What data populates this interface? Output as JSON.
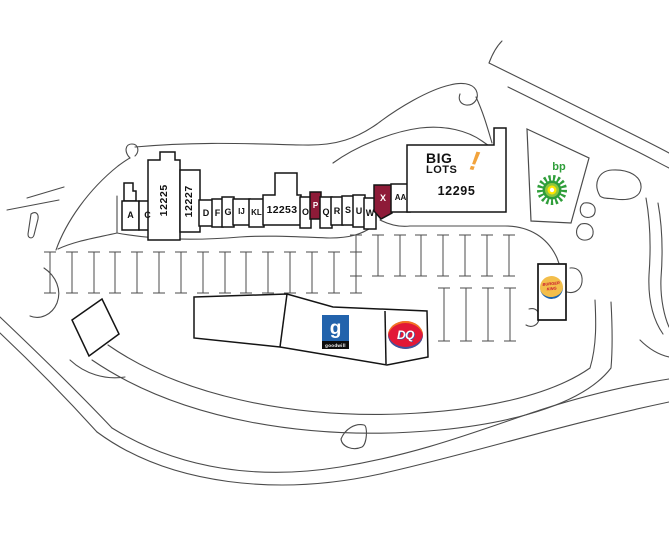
{
  "plaza": {
    "units": [
      {
        "label": "A"
      },
      {
        "label": "C"
      },
      {
        "label": "12225"
      },
      {
        "label": "12227"
      },
      {
        "label": "D"
      },
      {
        "label": "F"
      },
      {
        "label": "G"
      },
      {
        "label": "IJ"
      },
      {
        "label": "KL"
      },
      {
        "label": "12253"
      },
      {
        "label": "O"
      },
      {
        "label": "P",
        "highlighted": true
      },
      {
        "label": "Q"
      },
      {
        "label": "R"
      },
      {
        "label": "S"
      },
      {
        "label": "U"
      },
      {
        "label": "W"
      },
      {
        "label": "X",
        "highlighted": true
      },
      {
        "label": "AA"
      }
    ],
    "anchor": {
      "name_line1": "BIG",
      "name_line2": "LOTS",
      "exclamation": "!",
      "address": "12295"
    }
  },
  "outparcels": {
    "bp": {
      "name": "bp"
    },
    "goodwill": {
      "glyph": "g",
      "name": "goodwill"
    },
    "dairy_queen": {
      "name": "DQ"
    },
    "burger_king": {
      "name_line1": "BURGER",
      "name_line2": "KING"
    }
  },
  "colors": {
    "highlight_red": "#8E1B38",
    "biglots_orange": "#F2A33C",
    "bp_green": "#2F9E3A",
    "bp_light_green": "#8DC63F",
    "bp_yellow": "#FFE600",
    "goodwill_blue": "#2263AC",
    "dq_red": "#E21837",
    "dq_blue": "#2B5CAB",
    "dq_orange": "#F7941D",
    "bk_red": "#C8102E",
    "bk_yellow": "#F3BE4B",
    "bk_blue": "#1A62AD"
  }
}
